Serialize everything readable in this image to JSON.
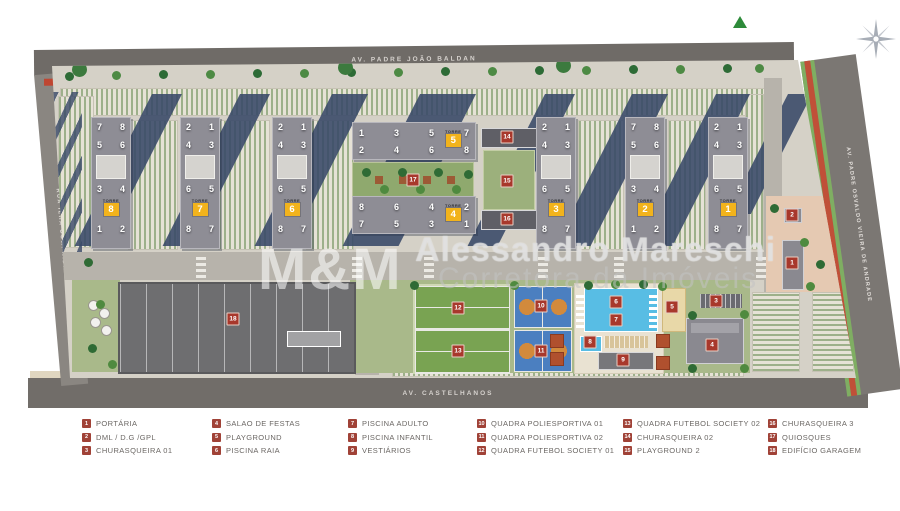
{
  "streets": {
    "top": "AV. PADRE JOÃO BALDAN",
    "bottom": "AV. CASTELHANOS",
    "left": "RUA ILHA COMPRIDA",
    "right": "AV. PADRE OSVALDO VIEIRA DE ANDRADE"
  },
  "watermark": {
    "mm": "M&M",
    "line1": "Alessandro Mareschi",
    "line2": "Corretora da Imóveis"
  },
  "towers": {
    "badge_label": "TORRE",
    "vertical": [
      {
        "num": "8",
        "cx": 110,
        "rows": [
          [
            "7",
            "8"
          ],
          [
            "5",
            "6"
          ],
          [
            "3",
            "4"
          ],
          [
            "1",
            "2"
          ]
        ]
      },
      {
        "num": "7",
        "cx": 199,
        "rows": [
          [
            "2",
            "1"
          ],
          [
            "4",
            "3"
          ],
          [
            "6",
            "5"
          ],
          [
            "8",
            "7"
          ]
        ]
      },
      {
        "num": "6",
        "cx": 291,
        "rows": [
          [
            "2",
            "1"
          ],
          [
            "4",
            "3"
          ],
          [
            "6",
            "5"
          ],
          [
            "8",
            "7"
          ]
        ]
      },
      {
        "num": "3",
        "cx": 555,
        "rows": [
          [
            "2",
            "1"
          ],
          [
            "4",
            "3"
          ],
          [
            "6",
            "5"
          ],
          [
            "8",
            "7"
          ]
        ]
      },
      {
        "num": "2",
        "cx": 644,
        "rows": [
          [
            "7",
            "8"
          ],
          [
            "5",
            "6"
          ],
          [
            "3",
            "4"
          ],
          [
            "1",
            "2"
          ]
        ]
      },
      {
        "num": "1",
        "cx": 727,
        "rows": [
          [
            "2",
            "1"
          ],
          [
            "4",
            "3"
          ],
          [
            "6",
            "5"
          ],
          [
            "8",
            "7"
          ]
        ]
      }
    ],
    "horizontal": [
      {
        "num": "5",
        "y": 122,
        "top": [
          "1",
          "3",
          "5",
          "7"
        ],
        "bottom": [
          "2",
          "4",
          "6",
          "8"
        ]
      },
      {
        "num": "4",
        "y": 196,
        "top": [
          "8",
          "6",
          "4",
          "2"
        ],
        "bottom": [
          "7",
          "5",
          "3",
          "1"
        ]
      }
    ]
  },
  "markers": [
    {
      "num": "1",
      "x": 792,
      "y": 263
    },
    {
      "num": "2",
      "x": 792,
      "y": 215
    },
    {
      "num": "3",
      "x": 716,
      "y": 301
    },
    {
      "num": "4",
      "x": 712,
      "y": 345
    },
    {
      "num": "5",
      "x": 672,
      "y": 307
    },
    {
      "num": "6",
      "x": 616,
      "y": 302
    },
    {
      "num": "7",
      "x": 616,
      "y": 320
    },
    {
      "num": "8",
      "x": 590,
      "y": 342
    },
    {
      "num": "9",
      "x": 623,
      "y": 360
    },
    {
      "num": "10",
      "x": 541,
      "y": 306
    },
    {
      "num": "11",
      "x": 541,
      "y": 351
    },
    {
      "num": "12",
      "x": 458,
      "y": 308
    },
    {
      "num": "13",
      "x": 458,
      "y": 351
    },
    {
      "num": "14",
      "x": 507,
      "y": 137
    },
    {
      "num": "15",
      "x": 507,
      "y": 181
    },
    {
      "num": "16",
      "x": 507,
      "y": 219
    },
    {
      "num": "17",
      "x": 413,
      "y": 180
    },
    {
      "num": "18",
      "x": 233,
      "y": 319
    }
  ],
  "legend": {
    "columns": [
      [
        {
          "num": "1",
          "label": "PORTÁRIA"
        },
        {
          "num": "2",
          "label": "DML / D.G /GPL"
        },
        {
          "num": "3",
          "label": "CHURASQUEIRA 01"
        }
      ],
      [
        {
          "num": "4",
          "label": "SALAO DE FESTAS"
        },
        {
          "num": "5",
          "label": "PLAYGROUND"
        },
        {
          "num": "6",
          "label": "PISCINA RAIA"
        }
      ],
      [
        {
          "num": "7",
          "label": "PISCINA ADULTO"
        },
        {
          "num": "8",
          "label": "PISCINA INFANTIL"
        },
        {
          "num": "9",
          "label": "VESTIÁRIOS"
        }
      ],
      [
        {
          "num": "10",
          "label": "QUADRA POLIESPORTIVA 01"
        },
        {
          "num": "11",
          "label": "QUADRA POLIESPORTIVA 02"
        },
        {
          "num": "12",
          "label": "QUADRA FUTEBOL SOCIETY 01"
        }
      ],
      [
        {
          "num": "13",
          "label": "QUADRA FUTEBOL SOCIETY 02"
        },
        {
          "num": "14",
          "label": "CHURASQUEIRA 02"
        },
        {
          "num": "15",
          "label": "PLAYGROUND 2"
        }
      ],
      [
        {
          "num": "16",
          "label": "CHURASQUEIRA 3"
        },
        {
          "num": "17",
          "label": "QUIOSQUES"
        },
        {
          "num": "18",
          "label": "EDIFÍCIO GARAGEM"
        }
      ]
    ]
  },
  "colors": {
    "tower_badge_yellow": "#f2b31c",
    "marker_red": "#a8382c",
    "legend_red": "#a04237",
    "cycle_path_red": "#bf4632",
    "road_gray": "#6f6b67",
    "field_green": "#79a352",
    "court_blue": "#4b7fc0",
    "pool_blue": "#58bde4"
  }
}
